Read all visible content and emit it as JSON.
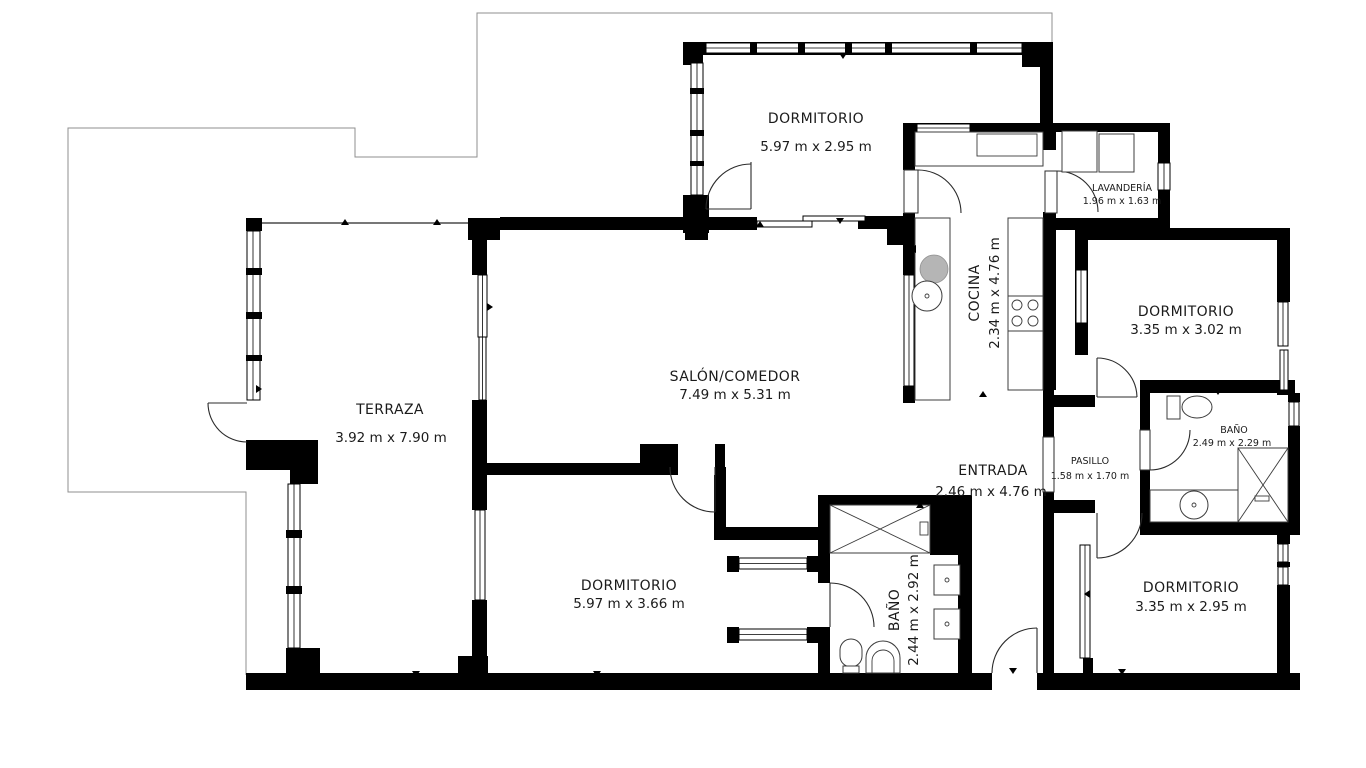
{
  "plan": {
    "type": "apartment-floor-plan",
    "colors": {
      "wall": "#000000",
      "background": "#ffffff",
      "boundary": "#8f8f8f",
      "text": "#1b1b1b"
    }
  },
  "rooms": {
    "dormitorio_top": {
      "name": "DORMITORIO",
      "dims": "5.97 m x 2.95 m"
    },
    "lavanderia": {
      "name": "LAVANDERÍA",
      "dims": "1.96 m x 1.63 m"
    },
    "cocina": {
      "name": "COCINA",
      "dims": "2.34 m x 4.76 m"
    },
    "dormitorio_right_top": {
      "name": "DORMITORIO",
      "dims": "3.35 m x 3.02 m"
    },
    "bano_right": {
      "name": "BAÑO",
      "dims": "2.49 m x 2.29 m"
    },
    "salon": {
      "name": "SALÓN/COMEDOR",
      "dims": "7.49 m x 5.31 m"
    },
    "terraza": {
      "name": "TERRAZA",
      "dims": "3.92 m x 7.90 m"
    },
    "entrada": {
      "name": "ENTRADA",
      "dims": "2.46 m x 4.76 m"
    },
    "pasillo": {
      "name": "PASILLO",
      "dims": "1.58 m x 1.70 m"
    },
    "dormitorio_bottom": {
      "name": "DORMITORIO",
      "dims": "5.97 m x 3.66 m"
    },
    "bano_bottom": {
      "name": "BAÑO",
      "dims": "2.44 m x 2.92 m"
    },
    "dormitorio_right_bottom": {
      "name": "DORMITORIO",
      "dims": "3.35 m x 2.95 m"
    }
  }
}
